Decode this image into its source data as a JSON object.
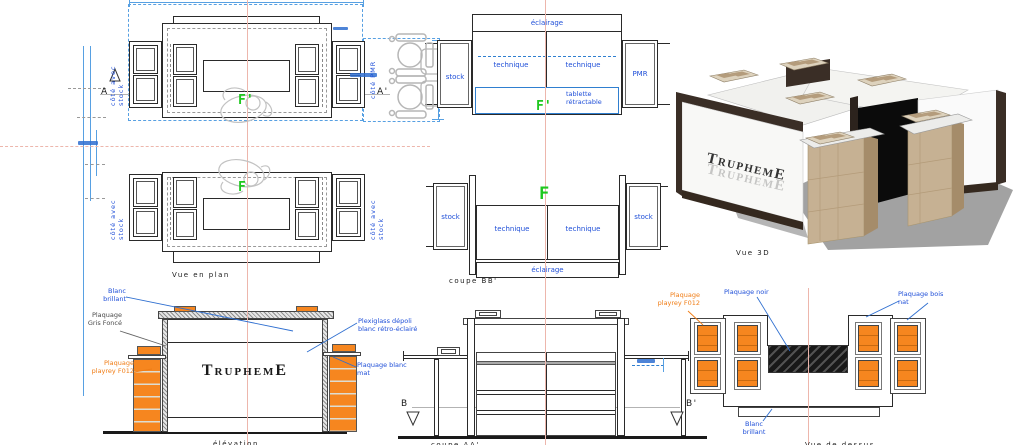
{
  "colors": {
    "label_blue": "#1f4fd8",
    "dim_blue": "#57a0e2",
    "orange": "#f6861f",
    "orange_text": "#f07d16",
    "green": "#1fc81f",
    "centerline_pink": "#edb6ac",
    "line_dark": "#2a2a2a"
  },
  "plan_top": {
    "side_left": "côté avec stock",
    "side_right": "côté PMR",
    "marker_left": "A",
    "marker_right": "A'",
    "letter": "F'"
  },
  "plan_bottom": {
    "side_left": "côté avec stock",
    "side_right": "côté avec stock",
    "letter": "F",
    "caption": "Vue en plan"
  },
  "coupe_face": {
    "eclairage": "éclairage",
    "technique_left": "technique",
    "technique_right": "technique",
    "stock_left": "stock",
    "pmr_right": "PMR",
    "tablette": "tablette rétractable",
    "letter": "F'"
  },
  "coupe_bb": {
    "letter": "F",
    "stock_left": "stock",
    "stock_right": "stock",
    "technique_left": "technique",
    "technique_right": "technique",
    "eclairage": "éclairage",
    "caption": "coupe BB'"
  },
  "vue_3d": {
    "brand": "TruphemE",
    "caption": "Vue 3D"
  },
  "elevation": {
    "brand": "TruphemE",
    "label_blanc_brillant": "Blanc brillant",
    "label_gris_fonce": "Plaquage Gris Foncé",
    "label_playrey": "Plaquage playrey F012",
    "label_plexi": "Plexiglass dépoli blanc rétro-éclairé",
    "label_blanc_mat": "Plaquage blanc mat",
    "caption": "élévation"
  },
  "coupe_aa": {
    "marker_left": "B",
    "marker_right": "B'",
    "caption": "coupe AA'"
  },
  "vue_dessus": {
    "label_playrey": "Plaquage playrey F012",
    "label_noir": "Plaquage noir",
    "label_bois": "Plaquage bois nat",
    "label_blanc_brillant": "Blanc brillant",
    "caption": "Vue de dessus"
  }
}
